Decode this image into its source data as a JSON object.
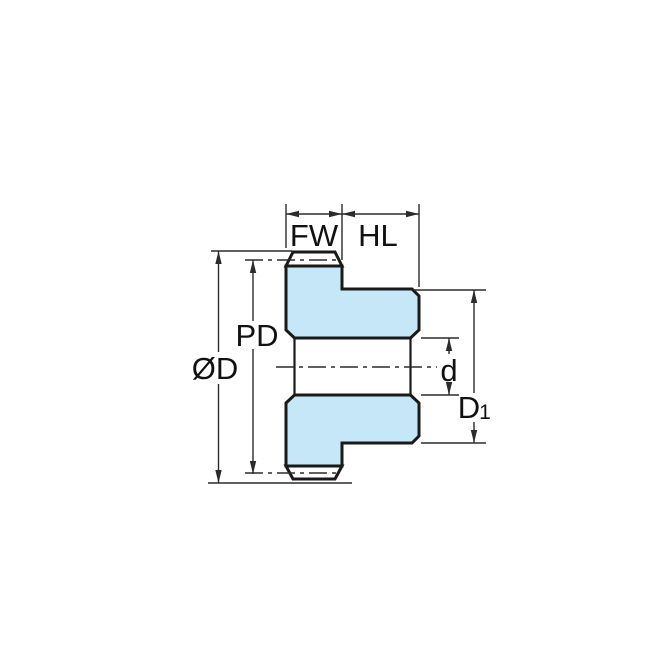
{
  "diagram": {
    "title": "spur-gear-hub-cross-section-dimension-drawing",
    "labels": {
      "face_width": "FW",
      "hub_length": "HL",
      "pitch_diameter": "PD",
      "outside_diameter": "ØD",
      "bore_diameter": "d",
      "hub_diameter_main": "D",
      "hub_diameter_sub": "1"
    },
    "colors": {
      "part_fill": "#C5E7F8",
      "outline": "#1A1A1A",
      "dimension_lines": "#2B2B2B",
      "background": "#FFFFFF"
    }
  }
}
